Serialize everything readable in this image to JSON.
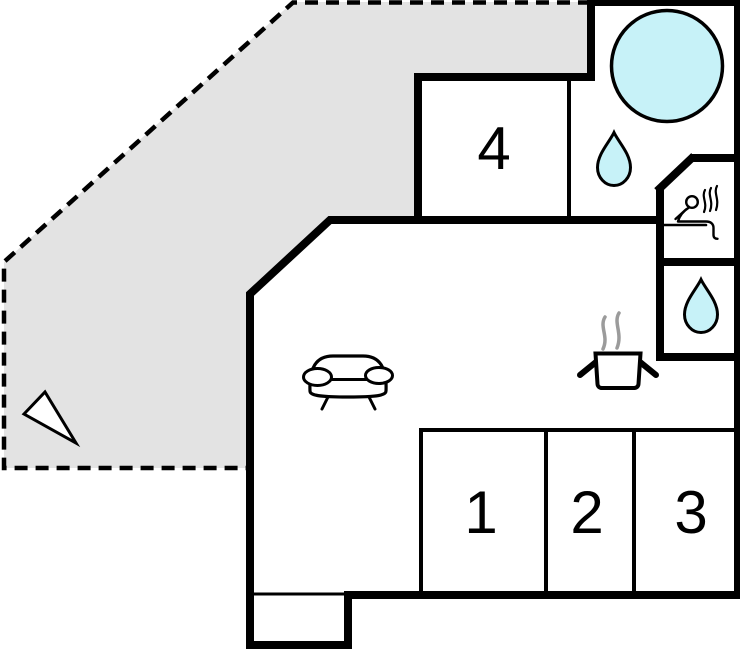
{
  "plan": {
    "rooms": [
      {
        "label": "1"
      },
      {
        "label": "2"
      },
      {
        "label": "3"
      },
      {
        "label": "4"
      }
    ],
    "icons": {
      "hot_tub": "large-circle",
      "bathroom_drop": "water-drop",
      "sauna": "person-on-bench-with-steam",
      "shower_drop": "water-drop",
      "sofa": "couch-front-view",
      "stove": "pot-with-steam",
      "compass": "triangle-north-arrow"
    },
    "colors": {
      "water": "#c7f2f8",
      "terrace": "#e3e3e3",
      "wall": "#000000",
      "steam": "#9b9b9b",
      "background": "#ffffff"
    }
  }
}
